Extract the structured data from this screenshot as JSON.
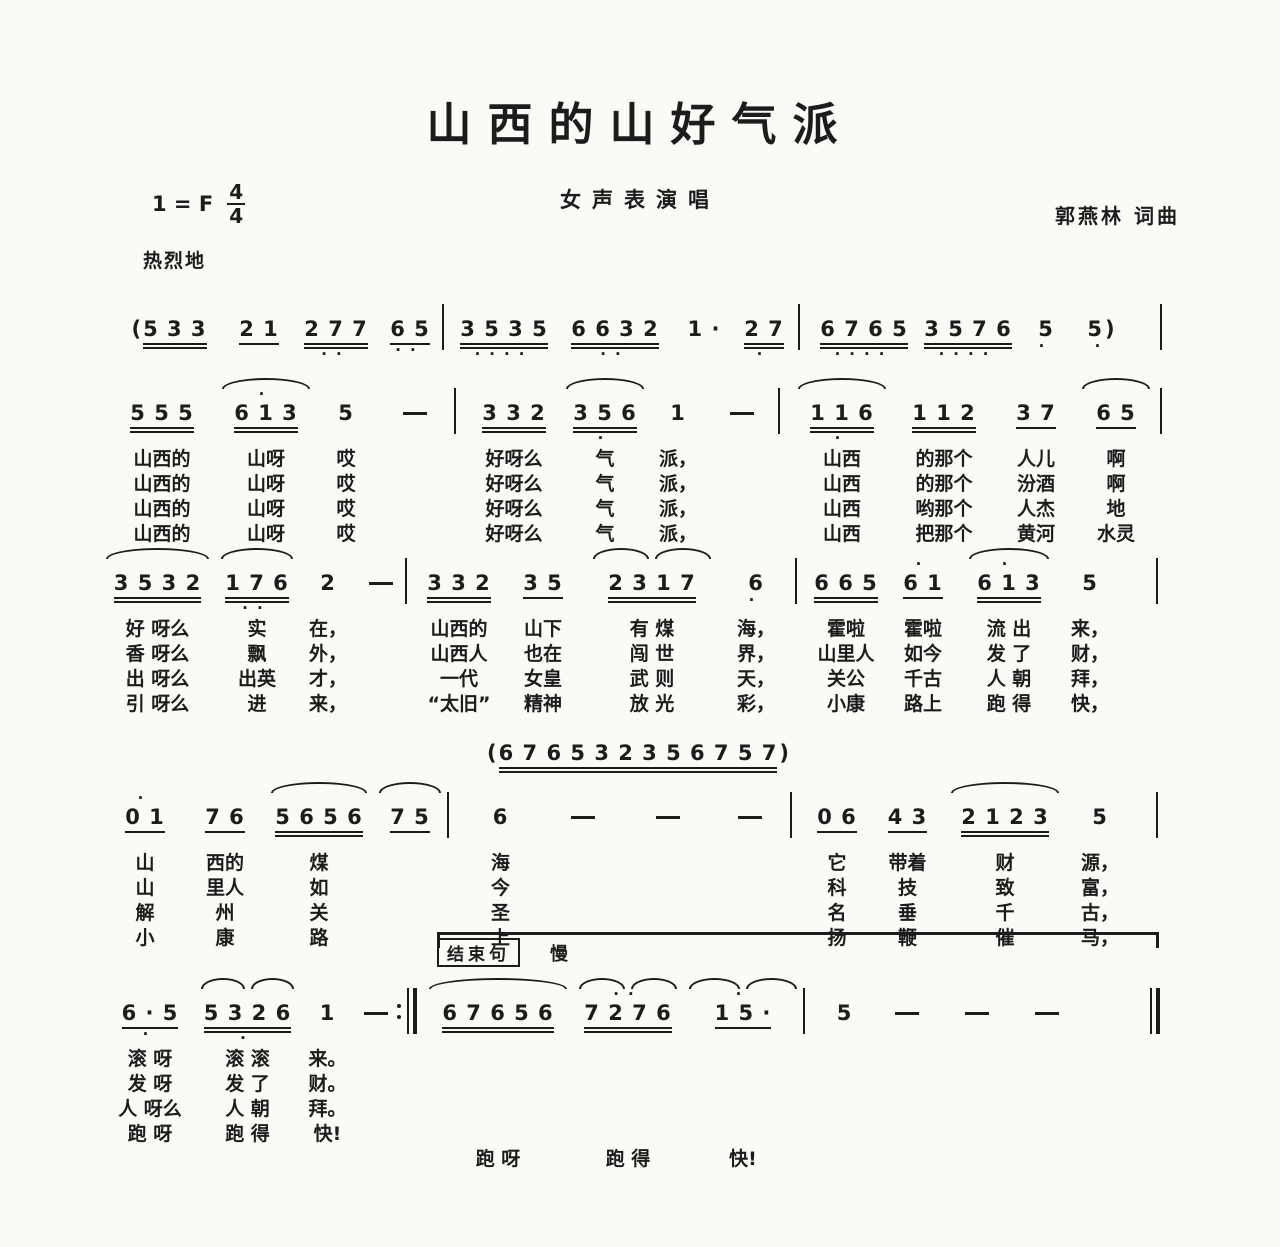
{
  "page": {
    "background": "#fbfaf6",
    "ink": "#1c1c1c"
  },
  "header": {
    "title": "山西的山好气派",
    "subtitle": "女声表演唱",
    "key": "1 = F",
    "meter_top": "4",
    "meter_bottom": "4",
    "composer": "郭燕林 词曲",
    "tempo": "热烈地"
  },
  "ending": {
    "boxed": "结束句",
    "tempo": "慢"
  },
  "interlude": {
    "pre": "(",
    "d": "6 7 6 5 3 2 3 5 6 7 5 7",
    "post": ")",
    "u": 2,
    "w": 300
  },
  "systems": [
    {
      "name": "intro",
      "cols": [
        {
          "pre": "(",
          "d": "5 3 3",
          "u": 2,
          "w": 112
        },
        {
          "d": "2 1",
          "u": 1,
          "w": 70
        },
        {
          "d": "2 7 7",
          "u": 2,
          "be": "··",
          "w": 84
        },
        {
          "d": "6 5",
          "u": 1,
          "be": "··",
          "w": 64
        },
        {
          "kind": "b",
          "w": 14
        },
        {
          "d": "3 5 3 5",
          "u": 2,
          "be": "····",
          "w": 96
        },
        {
          "d": "6 6 3 2",
          "u": 2,
          "be": "··",
          "w": 126
        },
        {
          "d": "1 ·",
          "w": 52
        },
        {
          "d": "2 7",
          "u": 2,
          "be": "·",
          "w": 68
        },
        {
          "kind": "b",
          "w": 14
        },
        {
          "d": "6 7 6 5",
          "u": 2,
          "be": "····",
          "w": 104
        },
        {
          "d": "3 5 7 6",
          "u": 2,
          "be": "····",
          "w": 104
        },
        {
          "d": "5",
          "be": "·",
          "w": 52
        },
        {
          "d": "5",
          "post": ")",
          "be": "·",
          "w": 60
        },
        {
          "kind": "b",
          "end": true
        }
      ]
    },
    {
      "name": "verse-line-1",
      "cols": [
        {
          "d": "5 5 5",
          "u": 2,
          "w": 108
        },
        {
          "d": "6 1 3",
          "u": 2,
          "arc": 1,
          "ab": "·",
          "w": 100
        },
        {
          "d": "5",
          "w": 60
        },
        {
          "d": "—",
          "w": 78
        },
        {
          "kind": "b",
          "w": 14
        },
        {
          "d": "3 3 2",
          "u": 2,
          "w": 92
        },
        {
          "d": "3 5 6",
          "u": 2,
          "arc": 1,
          "be": "·",
          "w": 90
        },
        {
          "d": "1",
          "w": 56
        },
        {
          "d": "—",
          "w": 72
        },
        {
          "kind": "b",
          "w": 14
        },
        {
          "d": "1 1 6",
          "u": 2,
          "arc": 1,
          "be": "·",
          "w": 100
        },
        {
          "d": "1 1 2",
          "u": 2,
          "w": 104
        },
        {
          "d": "3 7",
          "u": 1,
          "w": 80
        },
        {
          "d": "6 5",
          "u": 1,
          "arc": 1,
          "w": 80
        },
        {
          "kind": "b",
          "end": true
        }
      ],
      "lyrics": [
        [
          "山西的",
          "山呀",
          "哎",
          "",
          "",
          "好呀么",
          "气",
          "派，",
          "",
          "",
          "山西",
          "的那个",
          "人儿",
          "啊",
          ""
        ],
        [
          "山西的",
          "山呀",
          "哎",
          "",
          "",
          "好呀么",
          "气",
          "派，",
          "",
          "",
          "山西",
          "的那个",
          "汾酒",
          "啊",
          ""
        ],
        [
          "山西的",
          "山呀",
          "哎",
          "",
          "",
          "好呀么",
          "气",
          "派，",
          "",
          "",
          "山西",
          "哟那个",
          "人杰",
          "地",
          ""
        ],
        [
          "山西的",
          "山呀",
          "哎",
          "",
          "",
          "好呀么",
          "气",
          "派，",
          "",
          "",
          "山西",
          "把那个",
          "黄河",
          "水灵",
          ""
        ]
      ]
    },
    {
      "name": "verse-line-2",
      "cols": [
        {
          "d": "3 5 3 2",
          "u": 2,
          "arc": 1,
          "w": 115
        },
        {
          "d": "1 7 6",
          "u": 2,
          "arc": 1,
          "be": "··",
          "w": 84
        },
        {
          "d": "2",
          "w": 58
        },
        {
          "d": "—",
          "w": 48
        },
        {
          "kind": "b",
          "w": 14
        },
        {
          "d": "3 3 2",
          "u": 2,
          "w": 80
        },
        {
          "d": "3 5",
          "u": 1,
          "w": 88
        },
        {
          "d": "2 3 1 7",
          "u": 2,
          "arc": 2,
          "w": 130
        },
        {
          "d": "6",
          "be": "·",
          "w": 78
        },
        {
          "kind": "b",
          "w": 14
        },
        {
          "d": "6 6 5",
          "u": 2,
          "w": 74
        },
        {
          "d": "6 1",
          "u": 1,
          "ab": "·",
          "w": 80
        },
        {
          "d": "6 1 3",
          "u": 2,
          "arc": 1,
          "ab": "·",
          "w": 92
        },
        {
          "d": "5",
          "w": 70
        },
        {
          "kind": "b",
          "end": true
        }
      ],
      "lyrics": [
        [
          "好 呀么",
          "实",
          "在，",
          "",
          "",
          "山西的",
          "山下",
          "有 煤",
          "海，",
          "",
          "霍啦",
          "霍啦",
          "流 出",
          "来，",
          ""
        ],
        [
          "香 呀么",
          "飘",
          "外，",
          "",
          "",
          "山西人",
          "也在",
          "闯 世",
          "界，",
          "",
          "山里人",
          "如今",
          "发 了",
          "财，",
          ""
        ],
        [
          "出 呀么",
          "出英",
          "才，",
          "",
          "",
          "一代",
          "女皇",
          "武 则",
          "天，",
          "",
          "关公",
          "千古",
          "人 朝",
          "拜，",
          ""
        ],
        [
          "引 呀么",
          "进",
          "来，",
          "",
          "",
          "“太旧”",
          "精神",
          "放 光",
          "彩，",
          "",
          "小康",
          "路上",
          "跑 得",
          "快，",
          ""
        ]
      ]
    },
    {
      "name": "verse-line-3",
      "cols": [
        {
          "d": "0 1",
          "u": 1,
          "ab": "·",
          "w": 80
        },
        {
          "d": "7 6",
          "u": 1,
          "w": 80
        },
        {
          "d": "5 6 5 6",
          "u": 2,
          "arc": 1,
          "w": 108
        },
        {
          "d": "7 5",
          "u": 1,
          "arc": 1,
          "w": 74
        },
        {
          "kind": "b",
          "w": 14
        },
        {
          "d": "6",
          "w": 79
        },
        {
          "d": "—",
          "w": 85
        },
        {
          "d": "—",
          "w": 85
        },
        {
          "d": "—",
          "w": 80
        },
        {
          "kind": "b",
          "w": 14
        },
        {
          "d": "0 6",
          "u": 1,
          "w": 66
        },
        {
          "d": "4 3",
          "u": 1,
          "w": 75
        },
        {
          "d": "2 1 2 3",
          "u": 2,
          "arc": 1,
          "w": 120
        },
        {
          "d": "5",
          "w": 70
        },
        {
          "kind": "b",
          "end": true
        }
      ],
      "lyrics": [
        [
          "山",
          "西的",
          "煤",
          "",
          "",
          "海",
          "",
          "",
          "",
          "",
          "它",
          "带着",
          "财",
          "源，",
          ""
        ],
        [
          "山",
          "里人",
          "如",
          "",
          "",
          "今",
          "",
          "",
          "",
          "",
          "科",
          "技",
          "致",
          "富，",
          ""
        ],
        [
          "解",
          "州",
          "关",
          "",
          "",
          "圣",
          "",
          "",
          "",
          "",
          "名",
          "垂",
          "千",
          "古，",
          ""
        ],
        [
          "小",
          "康",
          "路",
          "",
          "",
          "上",
          "",
          "",
          "",
          "",
          "扬",
          "鞭",
          "催",
          "马，",
          ""
        ]
      ]
    },
    {
      "name": "ending-line",
      "has_ending_label": true,
      "cols": [
        {
          "d": "6 · 5",
          "u": 1,
          "be": "·",
          "w": 90
        },
        {
          "d": "5 3 2 6",
          "u": 2,
          "arc": 2,
          "be": "·",
          "w": 105
        },
        {
          "d": "1",
          "w": 55
        },
        {
          "d": "—",
          "w": 42
        },
        {
          "kind": "rb",
          "w": 26
        },
        {
          "d": "6 7 6 5 6",
          "u": 2,
          "arc": 1,
          "w": 150
        },
        {
          "d": "7 2 7 6",
          "u": 2,
          "arc": 2,
          "ab": "··",
          "w": 110
        },
        {
          "d": "1 5 ·",
          "u": 1,
          "arc": 2,
          "ab": "·",
          "w": 120
        },
        {
          "kind": "b",
          "w": 14
        },
        {
          "d": "5",
          "w": 55
        },
        {
          "d": "—",
          "w": 70
        },
        {
          "d": "—",
          "w": 70
        },
        {
          "d": "—",
          "w": 70
        },
        {
          "kind": "fb",
          "end": true
        }
      ],
      "lyrics": [
        [
          "滚 呀",
          "滚 滚",
          "来。",
          "",
          "",
          "",
          "",
          "",
          "",
          "",
          "",
          "",
          "",
          ""
        ],
        [
          "发 呀",
          "发 了",
          "财。",
          "",
          "",
          "",
          "",
          "",
          "",
          "",
          "",
          "",
          "",
          ""
        ],
        [
          "人 呀么",
          "人 朝",
          "拜。",
          "",
          "",
          "",
          "",
          "",
          "",
          "",
          "",
          "",
          "",
          ""
        ],
        [
          "跑 呀",
          "跑 得",
          "快!",
          "",
          "",
          "",
          "",
          "",
          "",
          "",
          "",
          "",
          "",
          ""
        ],
        [
          "",
          "",
          "",
          "",
          "",
          "跑 呀",
          "跑 得",
          "快!",
          "",
          "",
          "",
          "",
          "",
          ""
        ]
      ]
    }
  ]
}
